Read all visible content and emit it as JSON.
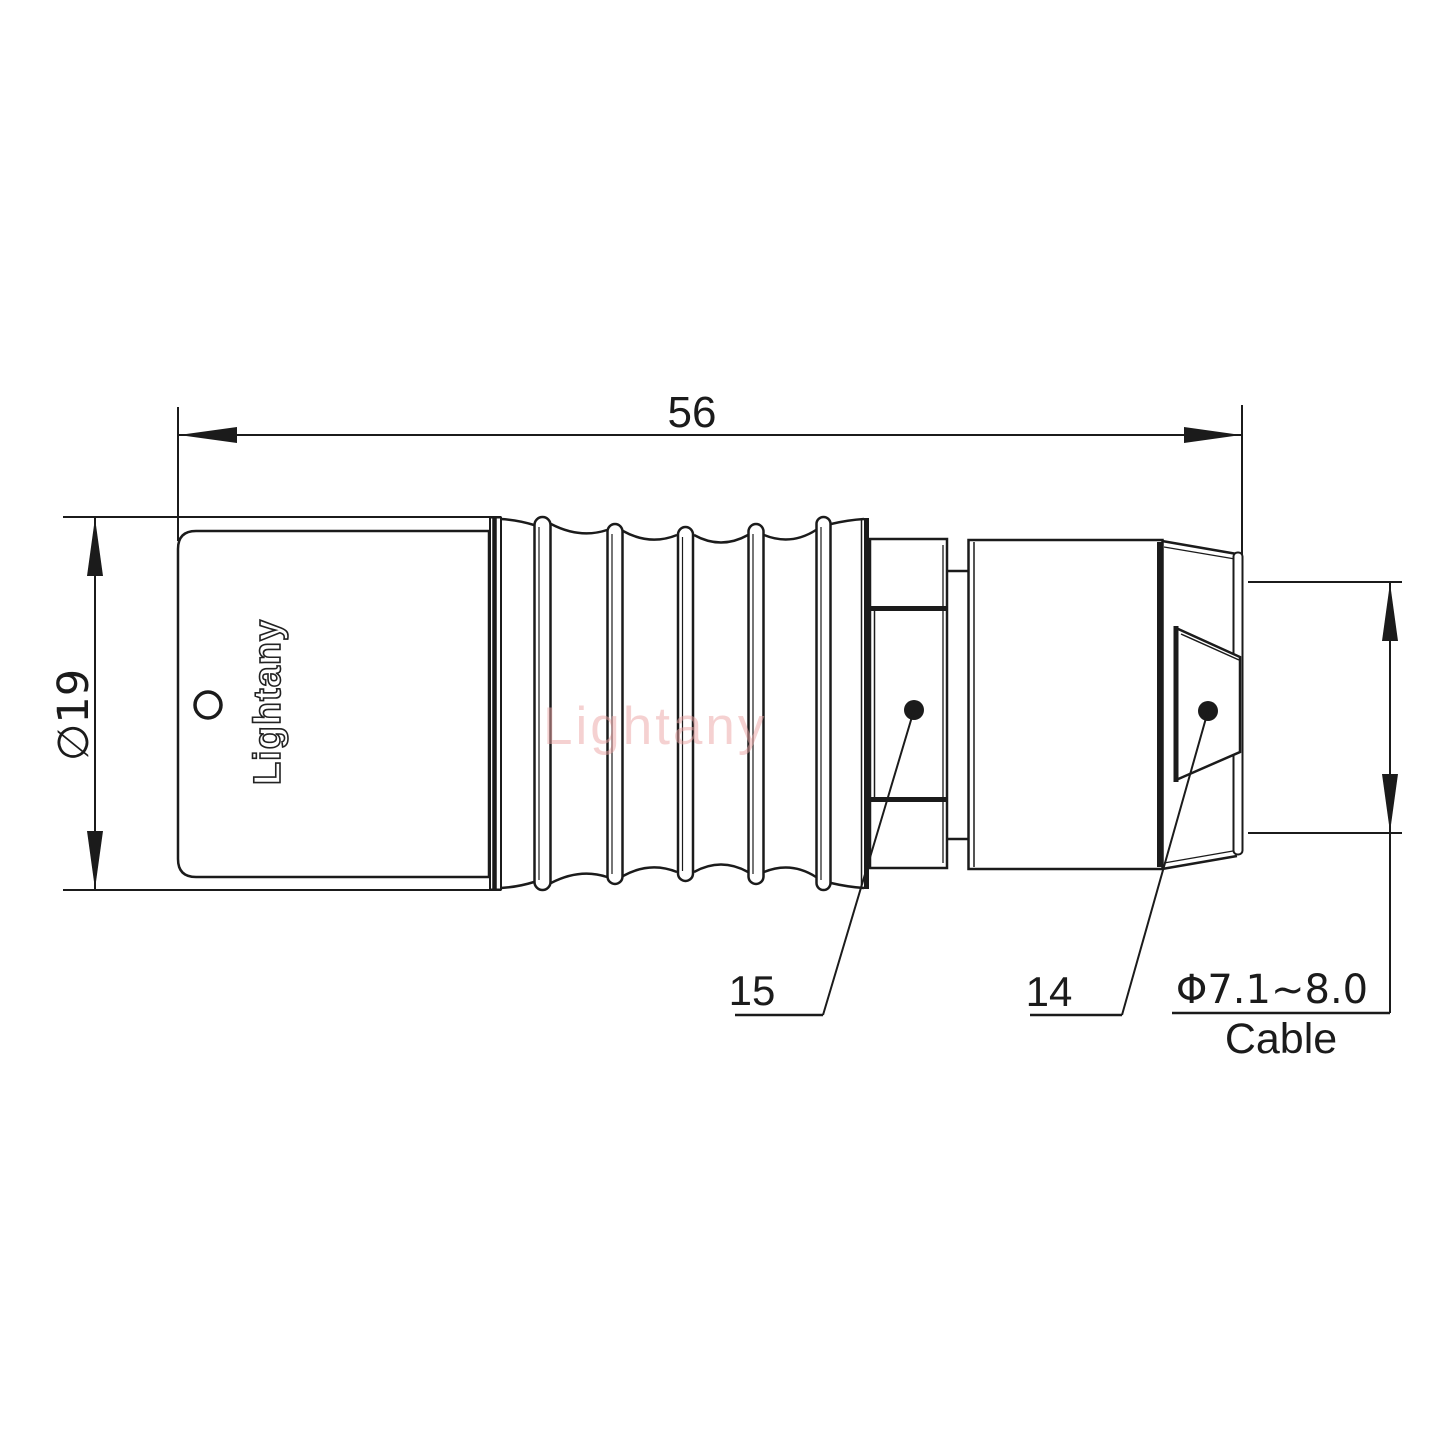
{
  "dimensions": {
    "overall_length": "56",
    "outer_diameter": "∅19",
    "cable_range": "Φ7.1~8.0",
    "cable_label": "Cable"
  },
  "part_labels": {
    "part_15": "15",
    "part_14": "14"
  },
  "branding": {
    "engraving": "Lightany",
    "watermark": "Lightany"
  },
  "colors": {
    "line": "#1b1b1b",
    "watermark": "#eda4a4",
    "background": "#ffffff"
  }
}
